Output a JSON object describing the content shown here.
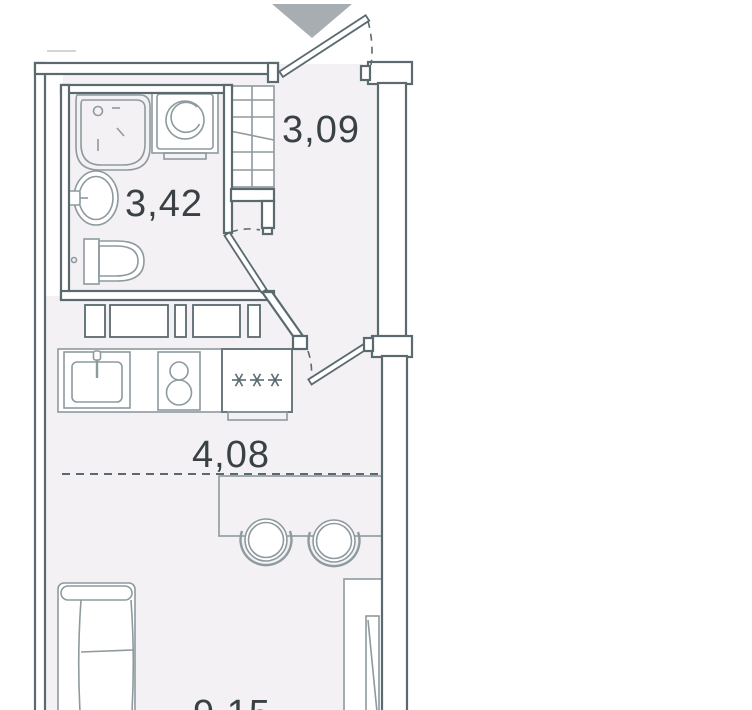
{
  "title": "Studio apartment floor plan",
  "colors": {
    "background": "#ffffff",
    "floor": "#f3f1f4",
    "wall": "#5a6a6f",
    "fixture": "#8e9a9e",
    "text": "#394145",
    "triangle": "#a8adb2"
  },
  "rooms": {
    "hallway": {
      "area": "3,09"
    },
    "bathroom": {
      "area": "3,42"
    },
    "kitchen_zone": {
      "area": "4,08"
    },
    "living_zone": {
      "area": "9,15",
      "partially_visible": true
    }
  },
  "fixtures": {
    "bathroom": [
      "shower-tray",
      "washing-machine",
      "washbasin",
      "toilet"
    ],
    "hallway": [
      "wardrobe-with-hangers",
      "entrance-door"
    ],
    "kitchen": [
      "kitchen-sink",
      "two-burner-hob",
      "fridge"
    ],
    "fridge_symbol": "***",
    "living": [
      "bar-counter",
      "bar-stool",
      "bar-stool",
      "sofa",
      "wardrobe"
    ]
  }
}
